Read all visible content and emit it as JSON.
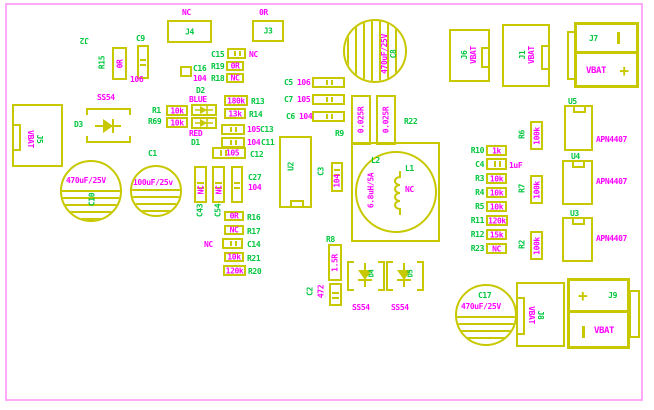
{
  "colors": {
    "silkscreen": "#c8c800",
    "designator_green": "#00c73e",
    "value_magenta": "#ff00ff",
    "board_outline_pink": "#ffaaf7",
    "background": "#ffffff"
  },
  "components": {
    "j2": {
      "ref": "J2"
    },
    "r15": {
      "ref": "R15",
      "value": "0R"
    },
    "c9": {
      "ref": "C9",
      "value": "106"
    },
    "j4": {
      "ref": "J4",
      "note": "NC"
    },
    "j3": {
      "ref": "J3",
      "note": "0R"
    },
    "c15": {
      "ref": "C15",
      "value": "NC"
    },
    "r19": {
      "ref": "R19",
      "value": "0R"
    },
    "r18": {
      "ref": "R18",
      "value": "NC"
    },
    "c16": {
      "ref": "C16",
      "value": "104"
    },
    "d2": {
      "ref": "D2",
      "value": "BLUE"
    },
    "d1": {
      "ref": "D1",
      "value": "RED"
    },
    "r1": {
      "ref": "R1",
      "value": "10k"
    },
    "r69": {
      "ref": "R69",
      "value": "10k"
    },
    "r13": {
      "ref": "R13",
      "value": "180k"
    },
    "r14": {
      "ref": "R14",
      "value": "13k"
    },
    "c13": {
      "ref": "C13",
      "value": "105"
    },
    "c11": {
      "ref": "C11",
      "value": "104"
    },
    "c12": {
      "ref": "C12",
      "value": "105"
    },
    "c43": {
      "ref": "C43",
      "value": "NC"
    },
    "c54": {
      "ref": "C54",
      "value": "NC"
    },
    "c27": {
      "ref": "C27",
      "value": "104"
    },
    "r16": {
      "ref": "R16",
      "value": "0R"
    },
    "r17": {
      "ref": "R17",
      "value": "NC"
    },
    "c14": {
      "ref": "C14",
      "value": "NC"
    },
    "r21": {
      "ref": "R21",
      "value": "10k"
    },
    "r20": {
      "ref": "R20",
      "value": "120k"
    },
    "c5": {
      "ref": "C5",
      "value": "106"
    },
    "c7": {
      "ref": "C7",
      "value": "105"
    },
    "c6": {
      "ref": "C6",
      "value": "104"
    },
    "u2": {
      "ref": "U2"
    },
    "c3": {
      "ref": "C3",
      "value": "104"
    },
    "c8": {
      "ref": "C8",
      "value": "470uF/25V"
    },
    "r9": {
      "ref": "R9",
      "value": "0.025R"
    },
    "r22": {
      "ref": "R22",
      "value": "0.025R"
    },
    "j6": {
      "ref": "J6",
      "value": "VBAT"
    },
    "j1": {
      "ref": "J1",
      "value": "VBAT"
    },
    "j7": {
      "ref": "J7",
      "value": "VBAT",
      "plus": "+"
    },
    "u5": {
      "ref": "U5",
      "value": "APN4407"
    },
    "u4": {
      "ref": "U4",
      "value": "APN4407"
    },
    "u3": {
      "ref": "U3",
      "value": "APN4407"
    },
    "r10": {
      "ref": "R10",
      "value": "1k"
    },
    "c4": {
      "ref": "C4",
      "value": "1uF"
    },
    "r3": {
      "ref": "R3",
      "value": "10k"
    },
    "r4": {
      "ref": "R4",
      "value": "10k"
    },
    "r5": {
      "ref": "R5",
      "value": "10k"
    },
    "r11": {
      "ref": "R11",
      "value": "120k"
    },
    "r12": {
      "ref": "R12",
      "value": "15k"
    },
    "r23": {
      "ref": "R23",
      "value": "NC"
    },
    "r6": {
      "ref": "R6",
      "value": "100k"
    },
    "r7": {
      "ref": "R7",
      "value": "100k"
    },
    "r2": {
      "ref": "R2",
      "value": "100k"
    },
    "l2": {
      "ref": "L2",
      "value": "6.8uH/5A"
    },
    "l1": {
      "ref": "L1",
      "value": "NC"
    },
    "r8": {
      "ref": "R8",
      "value": "1.5R"
    },
    "c2": {
      "ref": "C2",
      "value": "472"
    },
    "d3": {
      "ref": "D3",
      "part": "SS54"
    },
    "d4": {
      "ref": "D4",
      "part": "SS54"
    },
    "d5": {
      "ref": "D5",
      "part": "SS54"
    },
    "c17": {
      "ref": "C17",
      "value": "470uF/25V"
    },
    "c10": {
      "ref": "C10",
      "value": "470uF/25V"
    },
    "c1": {
      "ref": "C1",
      "value": "100uF/25v"
    },
    "j5": {
      "ref": "J5",
      "value": "VBAT"
    },
    "j8": {
      "ref": "J8",
      "value": "VBAT"
    },
    "j9": {
      "ref": "J9",
      "value": "VBAT",
      "plus": "+"
    }
  }
}
